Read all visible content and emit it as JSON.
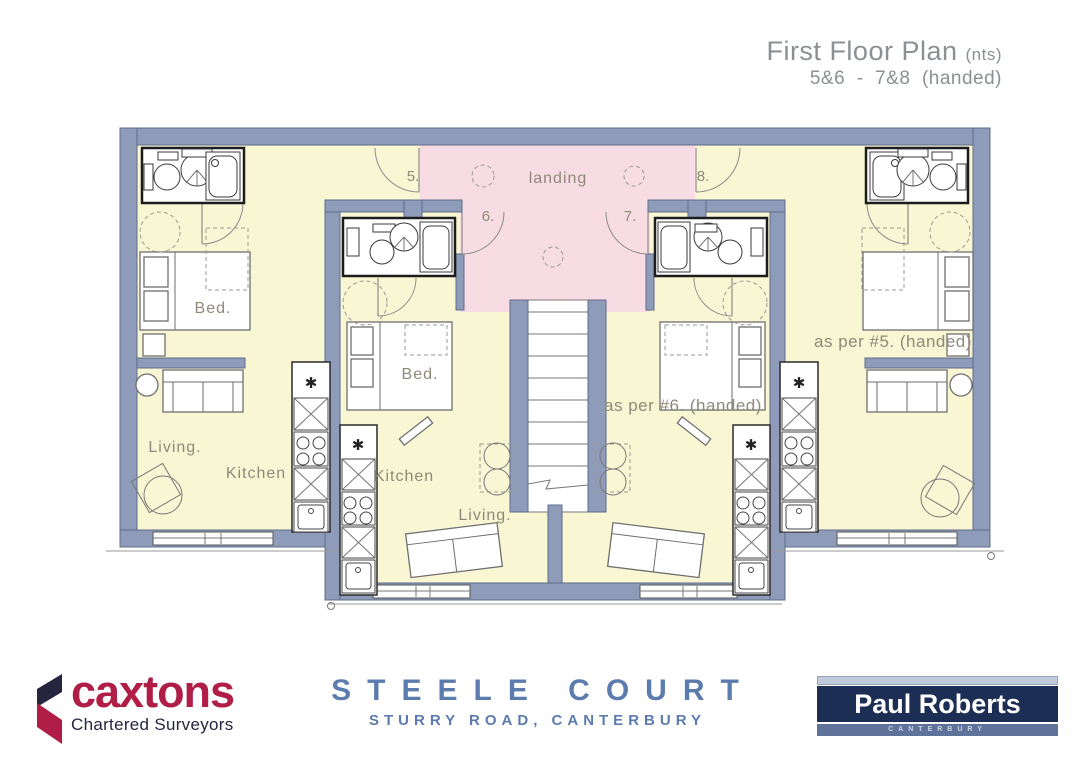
{
  "title": {
    "main": "First Floor Plan ",
    "suffix": "(nts)",
    "sub": "5&6  -  7&8  (handed)"
  },
  "plan": {
    "landing": "landing",
    "unit5": "5.",
    "unit6": "6.",
    "unit7": "7.",
    "unit8": "8.",
    "bed5": "Bed.",
    "bed6": "Bed.",
    "living5": "Living.",
    "living6": "Living.",
    "kitchen5": "Kitchen",
    "kitchen6": "Kitchen",
    "note_unit7": "as per #6. (handed)",
    "note_unit8": "as per #5. (handed)",
    "boiler_symbol": "✱"
  },
  "footer": {
    "caxtons": {
      "name": "caxtons",
      "tagline": "Chartered Surveyors"
    },
    "project": {
      "name": "STEELE COURT",
      "address": "STURRY ROAD, CANTERBURY"
    },
    "paul_roberts": {
      "name": "Paul Roberts",
      "city": "CANTERBURY"
    }
  },
  "colors": {
    "wall": "#8e9cba",
    "wallEdge": "#5f6c8a",
    "room": "#f9f6d4",
    "landing": "#f8dce3",
    "ink": "#666666",
    "label": "#8f897a",
    "titleGray": "#8b9095",
    "steel": "#5b7cad",
    "crimson": "#b01d46",
    "navyDark": "#252540",
    "prNavy": "#1d2e55",
    "prBand": "#5f7299",
    "prLight": "#c0cbdb",
    "prText": "#ccd4e0"
  }
}
